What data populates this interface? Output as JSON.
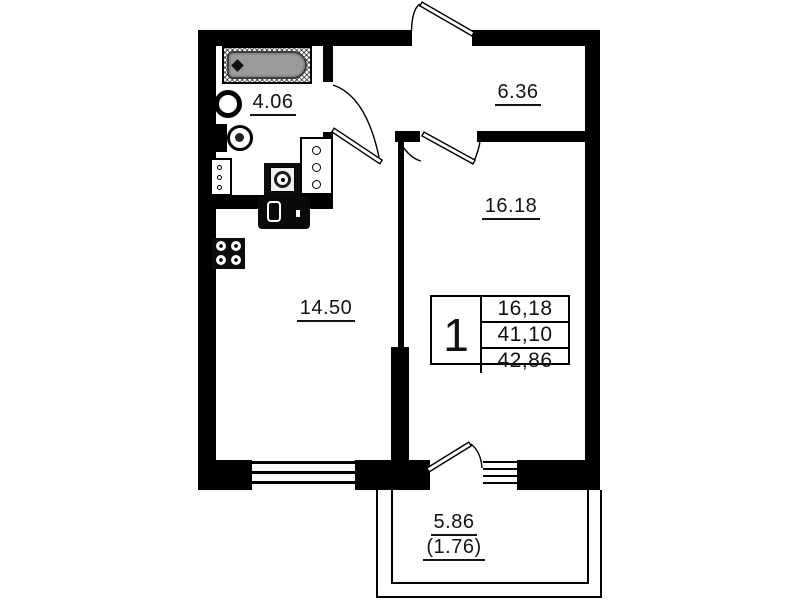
{
  "rooms": {
    "bathroom": {
      "label": "4.06"
    },
    "hallway": {
      "label": "6.36"
    },
    "bedroom": {
      "label": "16.18"
    },
    "living_kitchen": {
      "label": "14.50"
    },
    "balcony": {
      "label": "5.86",
      "label_reduced": "(1.76)"
    }
  },
  "info_box": {
    "room_count": "1",
    "living_area": "16,18",
    "residential_area": "41,10",
    "total_area": "42,86"
  },
  "colors": {
    "wall": "#000000",
    "background": "#ffffff",
    "bathtub_fill": "#9b9b9b"
  }
}
